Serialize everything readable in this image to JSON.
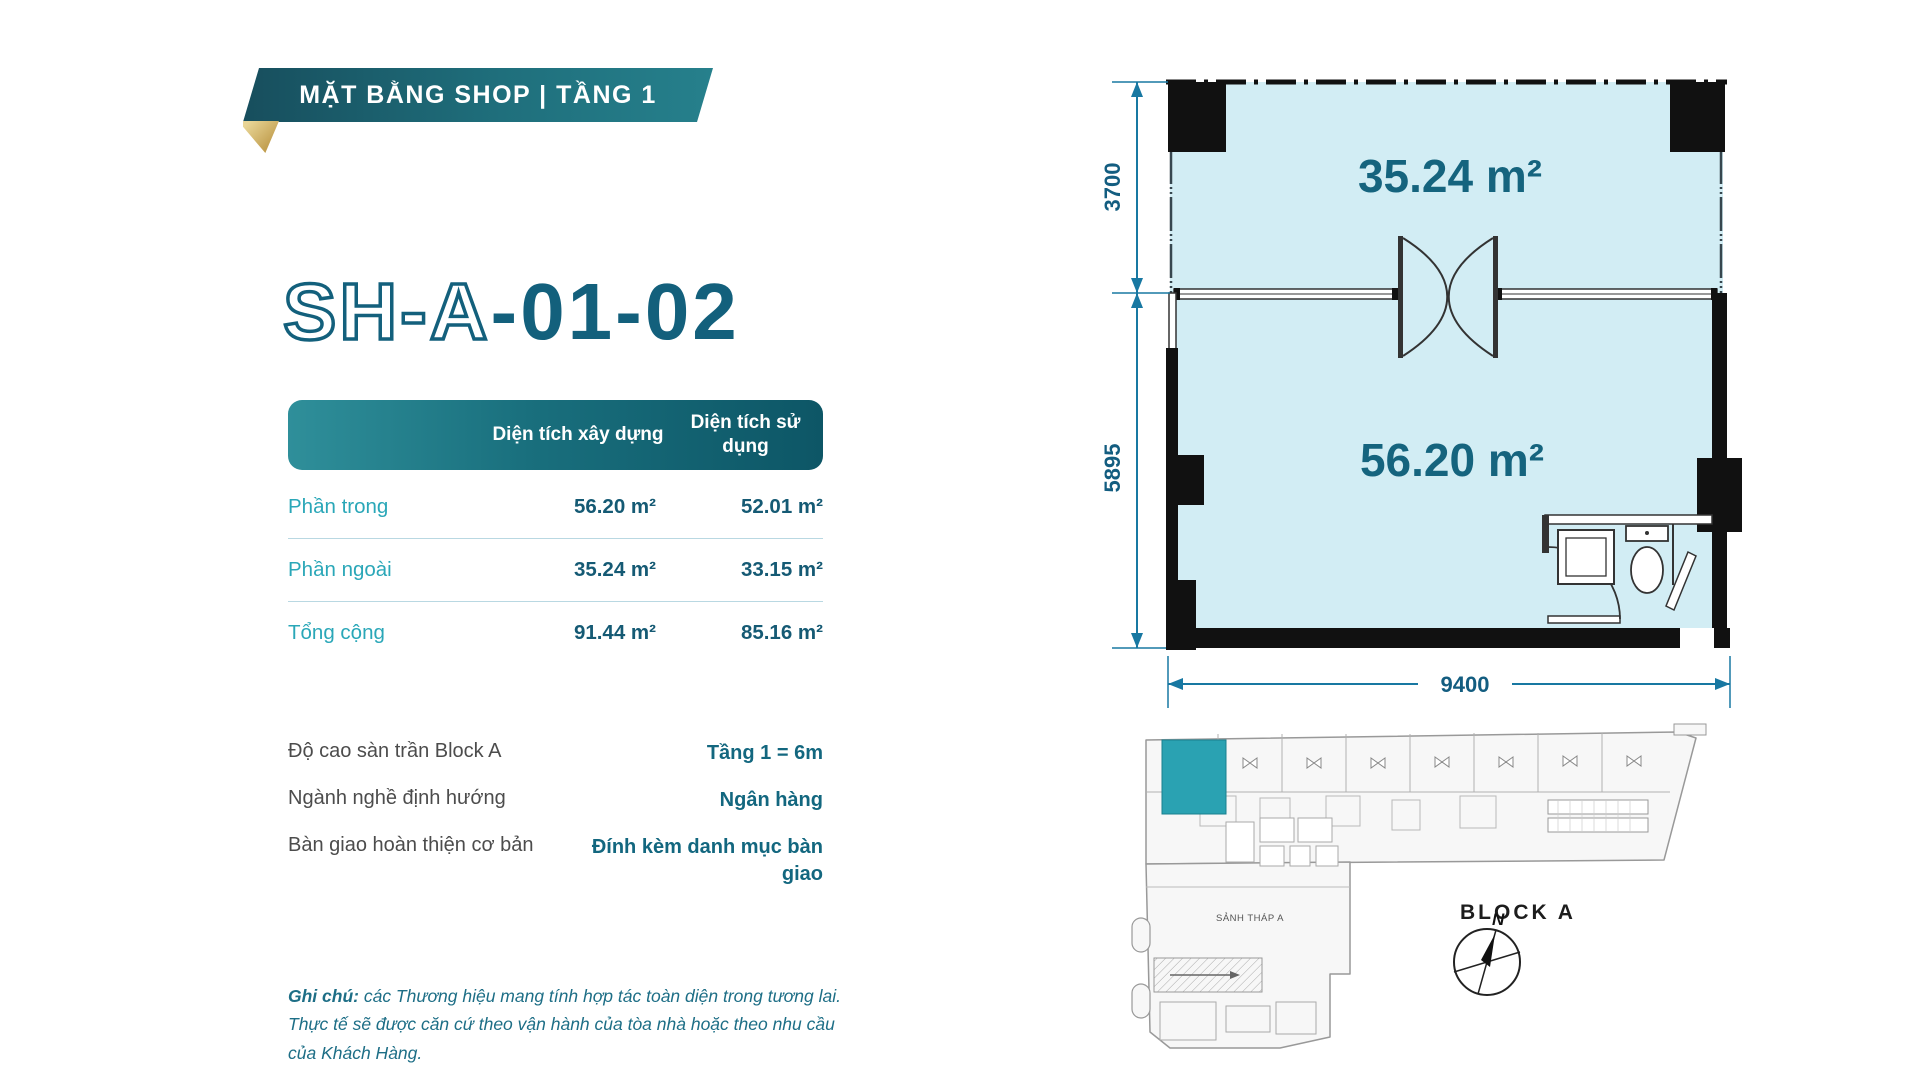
{
  "banner": {
    "title": "MẶT BẰNG SHOP | TẦNG 1"
  },
  "unit": {
    "code_outline": "SH-A",
    "code_solid": "-01-02"
  },
  "area_table": {
    "col_built": "Diện tích xây dựng",
    "col_usable": "Diện tích sử dụng",
    "rows": [
      {
        "label": "Phần trong",
        "built": "56.20 m²",
        "usable": "52.01 m²"
      },
      {
        "label": "Phần ngoài",
        "built": "35.24 m²",
        "usable": "33.15 m²"
      },
      {
        "label": "Tổng cộng",
        "built": "91.44 m²",
        "usable": "85.16 m²"
      }
    ]
  },
  "details": [
    {
      "label": "Độ cao sàn trần Block A",
      "value": "Tầng 1 = 6m"
    },
    {
      "label": "Ngành nghề định hướng",
      "value": "Ngân hàng"
    },
    {
      "label": "Bàn giao hoàn thiện cơ bản",
      "value": "Đính kèm danh mục bàn giao"
    }
  ],
  "note": {
    "prefix": "Ghi chú:",
    "body": " các Thương hiệu mang tính hợp tác toàn diện trong tương lai. Thực tế sẽ được căn cứ theo vận hành của tòa nhà hoặc theo nhu cầu của Khách Hàng."
  },
  "floor_plan": {
    "upper_room_area": "35.24 m²",
    "lower_room_area": "56.20 m²",
    "dim_upper": "3700",
    "dim_lower": "5895",
    "dim_width": "9400"
  },
  "key_plan": {
    "lobby_label": "SẢNH THÁP A",
    "block_label": "BLOCK A",
    "compass_north": "N"
  },
  "colors": {
    "brand_teal_dark": "#13607c",
    "ribbon_teal": "#1f6f7c",
    "accent_cyan": "#2aa7b8",
    "value_teal": "#155a74",
    "room_fill": "#d2edf4",
    "highlight_unit": "#2aa2b2",
    "gold_fold": "#c9a84c",
    "dimension_blue": "#1878a2"
  }
}
